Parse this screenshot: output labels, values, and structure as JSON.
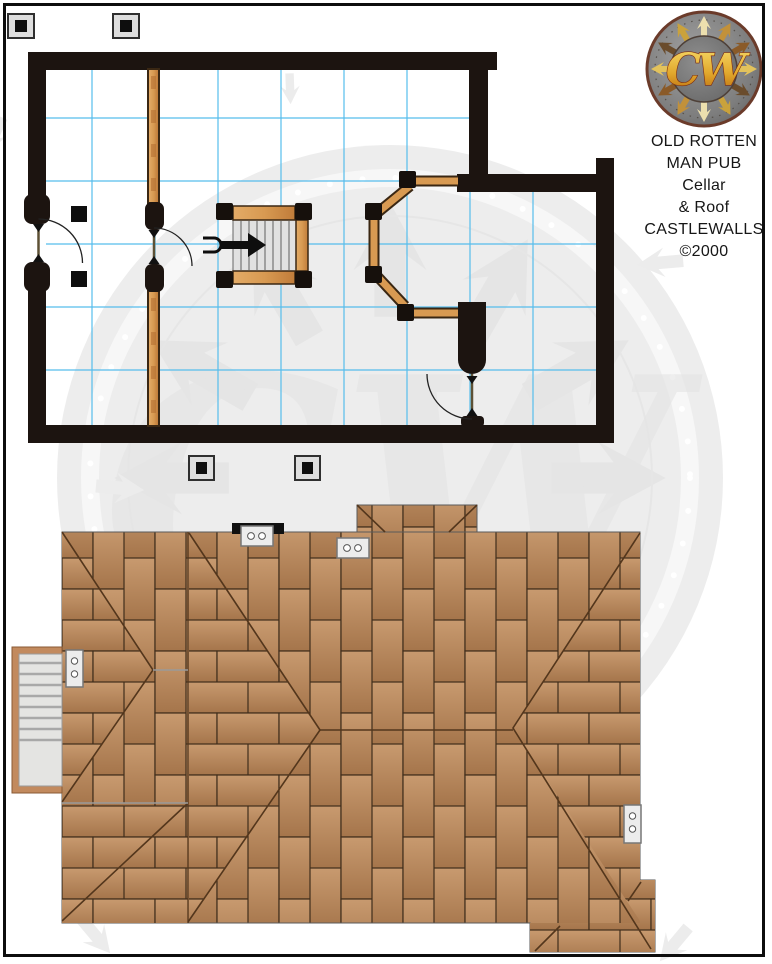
{
  "page": {
    "background": "#ffffff",
    "border_color": "#0d0d0d",
    "watermark_color": "#ededed"
  },
  "logo": {
    "monogram": "CW",
    "title_lines": [
      "OLD ROTTEN",
      "MAN PUB",
      "Cellar",
      "& Roof",
      "CASTLEWALLS",
      "©2000"
    ],
    "disc_color": "#7d7d7d",
    "rim_color": "#6b3b2a",
    "monogram_gold": "#e8b83a"
  },
  "cellar": {
    "wall_color": "#1c1410",
    "grid_color": "#56bdec",
    "wood_color": "#d99c5c",
    "stair_step_count": 7,
    "interior_pillars": 2,
    "exterior_pillars_top": 2,
    "exterior_pillars_bottom": 2,
    "doors": 3,
    "entry_arrow_direction": "right"
  },
  "roof": {
    "tile_fill": "#b98a62",
    "tile_line_color": "#3f2d1b",
    "hip_line_color": "#53361c",
    "vent_count": 4,
    "vent_hole_count": 2,
    "chimney_bar_color": "#111111",
    "dormer": true,
    "external_stair_steps": 8
  }
}
